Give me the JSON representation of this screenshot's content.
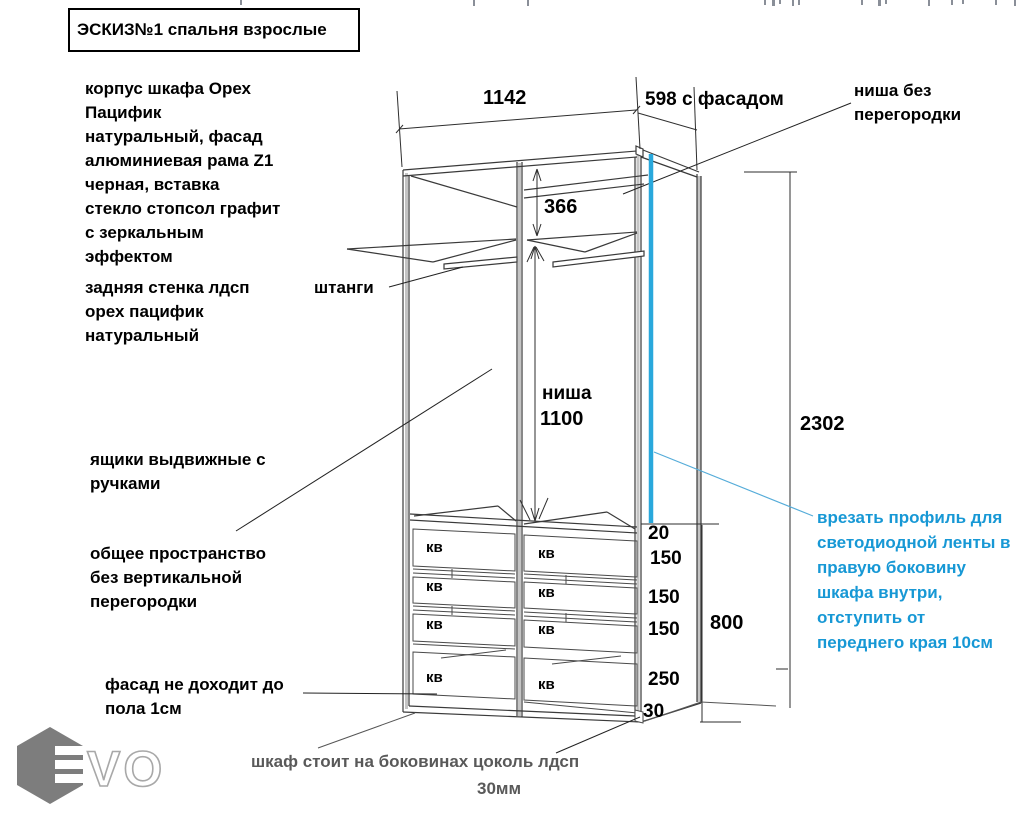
{
  "title": "ЭСКИЗ№1 спальня взрослые",
  "annotations": {
    "corpus": "корпус шкафа Орех\nПацифик\nнатуральный, фасад\nалюминиевая рама Z1\nчерная, вставка\nстекло стопсол графит\nс зеркальным\nэффектом",
    "back_wall": "задняя стенка лдсп\nорех пацифик\nнатуральный",
    "rods": "штанги",
    "drawers_note": "ящики выдвижные с\nручками",
    "shared_space": "общее пространство\nбез вертикальной\nперегородки",
    "facade_gap": "фасад не доходит до\nпола 1см",
    "niche_no_partition": "ниша без\nперегородки",
    "led_profile": "врезать профиль для\nсветодиодной ленты в\nправую боковину\nшкафа внутри,\nотступить от\nпереднего края 10см",
    "base_note": "шкаф стоит на боковинах  цоколь лдсп",
    "base_thickness": "30мм"
  },
  "dimensions": {
    "width_top": "1142",
    "depth": "598 с фасадом",
    "top_section": "366",
    "niche_label": "ниша",
    "niche_height": "1100",
    "total_height": "2302",
    "drawer_unit_height": "800",
    "right_stack": [
      "20",
      "150",
      "150",
      "150",
      "250",
      "30"
    ]
  },
  "drawers": {
    "label": "кв",
    "count": 8
  },
  "logo": {
    "text": "VO"
  },
  "colors": {
    "led_strip": "#29A8DC",
    "note_blue": "#1798D5",
    "gray_text": "#595959"
  }
}
